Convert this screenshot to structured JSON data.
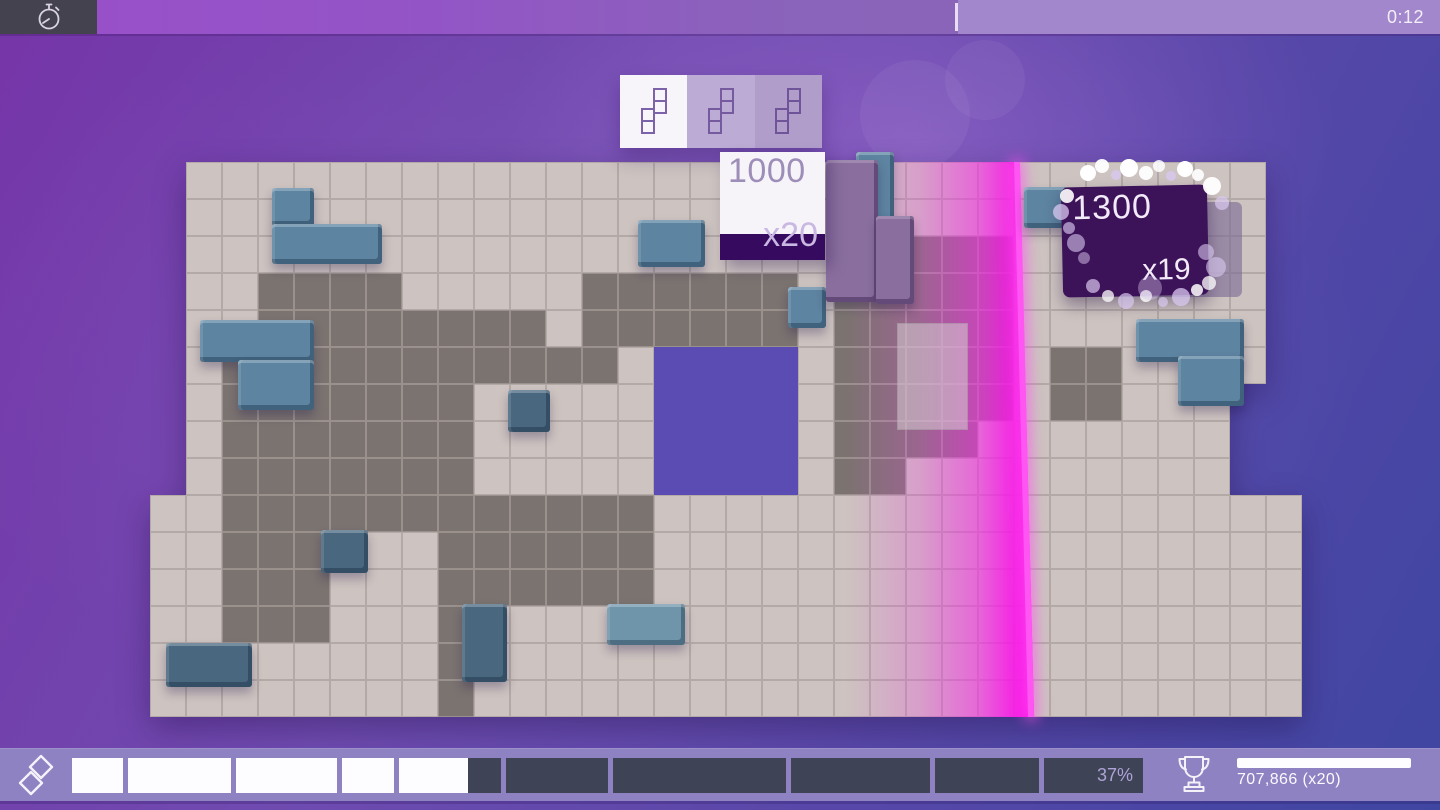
{
  "top_bar": {
    "timer": "0:12"
  },
  "next_pieces": {
    "slots": [
      {
        "piece": "s-piece",
        "state": "current"
      },
      {
        "piece": "s-piece",
        "state": "next"
      },
      {
        "piece": "s-piece",
        "state": "after"
      }
    ]
  },
  "score_popups": [
    {
      "points": "1000",
      "multiplier": "x20"
    },
    {
      "points": "1300",
      "multiplier": "x19"
    }
  ],
  "bottom_hud": {
    "progress_percent": "37%",
    "fill_ratio": 0.37,
    "score": "707,866 (x20)"
  },
  "board": {
    "legend": {
      ".": "background",
      "e": "empty-tile",
      "f": "filled-gray",
      "h": "hole"
    },
    "colors": {
      "empty": "#cdc3c0",
      "empty_grout": "#b3a9a6",
      "filled": "#7b7370",
      "filled_grout": "#9a918d",
      "hole": "#5b4cb4"
    },
    "rows": [
      ".eeeeeeeeeeeeeeeeeeeeeeeeeeeeee.",
      ".eeeeeeeeeeeeeeeeeeeeeeeeeeeeee.",
      ".eeeeeeeeeeeeeeeeeeeffffeeeeeee.",
      ".eeffffeeeeeffffffefffffeeeeeee.",
      ".eeffffffffeffffffefffffeeeeeee.",
      ".efffffffffffehhhhefffffeffeeee.",
      ".efffffffeeeeehhhhefffffeffeee..",
      ".efffffffeeeeehhhheffffeeeeeee..",
      ".efffffffeeeeehhhheffeeeeeeeee..",
      "eeffffffffffffeeeeeeeeeeeeeeeeee",
      "eefffeeeffffffeeeeeeeeeeeeeeeeee",
      "eefffeeeffffffeeeeeeeeeeeeeeeeee",
      "eefffeeefeeeeeeeeeeeeeeeeeeeeeee",
      "eeeeeeeefeeeeeeeeeeeeeeeeeeeeeee",
      "eeeeeeeefeeeeeeeeeeeeeeeeeeeeeee"
    ]
  },
  "pieces": [
    {
      "name": "blue-l-block",
      "shade": "steel",
      "parts": [
        [
          272,
          188,
          42,
          38
        ],
        [
          272,
          224,
          110,
          40
        ]
      ]
    },
    {
      "name": "blue-l-block",
      "shade": "steel",
      "parts": [
        [
          200,
          320,
          114,
          42
        ],
        [
          238,
          360,
          76,
          50
        ]
      ]
    },
    {
      "name": "blue-cube",
      "shade": "steel-dark",
      "parts": [
        [
          508,
          390,
          42,
          42
        ]
      ]
    },
    {
      "name": "blue-domino",
      "shade": "steel-dark",
      "parts": [
        [
          166,
          643,
          86,
          44
        ]
      ]
    },
    {
      "name": "blue-domino",
      "shade": "steel-dark",
      "parts": [
        [
          462,
          604,
          45,
          78
        ]
      ]
    },
    {
      "name": "blue-domino",
      "shade": "steel-light",
      "parts": [
        [
          607,
          604,
          78,
          41
        ]
      ]
    },
    {
      "name": "blue-cube",
      "shade": "steel",
      "parts": [
        [
          788,
          287,
          38,
          41
        ]
      ]
    },
    {
      "name": "blue-domino",
      "shade": "steel",
      "parts": [
        [
          856,
          152,
          38,
          76
        ]
      ]
    },
    {
      "name": "blue-cube",
      "shade": "steel",
      "parts": [
        [
          1024,
          187,
          44,
          41
        ]
      ]
    },
    {
      "name": "blue-domino",
      "shade": "steel",
      "parts": [
        [
          638,
          220,
          67,
          47
        ]
      ]
    },
    {
      "name": "blue-l-block",
      "shade": "steel",
      "parts": [
        [
          1136,
          319,
          108,
          43
        ],
        [
          1178,
          356,
          66,
          50
        ]
      ]
    },
    {
      "name": "blue-cube",
      "shade": "steel-dark",
      "parts": [
        [
          321,
          530,
          47,
          43
        ]
      ]
    },
    {
      "name": "purple-piece",
      "shade": "plum",
      "parts": [
        [
          826,
          160,
          52,
          142
        ],
        [
          876,
          216,
          38,
          88
        ]
      ]
    }
  ],
  "ghost_piece": {
    "x": 897,
    "y": 323,
    "w": 71,
    "h": 107
  },
  "particles": [
    [
      1088,
      173,
      8,
      1,
      "w"
    ],
    [
      1102,
      166,
      7,
      0.95,
      "w"
    ],
    [
      1116,
      175,
      5,
      0.8,
      "l"
    ],
    [
      1129,
      168,
      9,
      1,
      "w"
    ],
    [
      1146,
      173,
      7,
      0.95,
      "w"
    ],
    [
      1159,
      166,
      6,
      0.85,
      "w"
    ],
    [
      1171,
      176,
      5,
      0.8,
      "l"
    ],
    [
      1185,
      169,
      8,
      1,
      "w"
    ],
    [
      1198,
      175,
      6,
      0.9,
      "w"
    ],
    [
      1212,
      186,
      9,
      0.95,
      "w"
    ],
    [
      1222,
      203,
      7,
      0.7,
      "l"
    ],
    [
      1067,
      196,
      7,
      0.9,
      "w"
    ],
    [
      1061,
      212,
      8,
      0.75,
      "l"
    ],
    [
      1069,
      228,
      6,
      0.65,
      "l"
    ],
    [
      1076,
      243,
      9,
      0.6,
      "l"
    ],
    [
      1084,
      258,
      6,
      0.5,
      "l"
    ],
    [
      1093,
      286,
      7,
      0.7,
      "l"
    ],
    [
      1108,
      296,
      6,
      0.75,
      "w"
    ],
    [
      1126,
      301,
      8,
      0.7,
      "l"
    ],
    [
      1146,
      296,
      6,
      0.8,
      "w"
    ],
    [
      1163,
      302,
      5,
      0.7,
      "l"
    ],
    [
      1181,
      297,
      9,
      0.75,
      "l"
    ],
    [
      1197,
      290,
      6,
      0.85,
      "w"
    ],
    [
      1206,
      252,
      8,
      0.6,
      "l"
    ],
    [
      1216,
      267,
      10,
      0.6,
      "l"
    ],
    [
      1209,
      283,
      7,
      0.75,
      "w"
    ],
    [
      1150,
      288,
      12,
      0.4,
      "l"
    ]
  ],
  "colors": {
    "accent_magenta": "#fb12ea",
    "hud_bar": "#8e82c3",
    "segment_dark": "#3e4356",
    "card_dark_strip": "#360a5e",
    "steel_block": "#5d84a1",
    "particle_white": "#ffffff",
    "particle_lavender": "#d9c8f0"
  }
}
